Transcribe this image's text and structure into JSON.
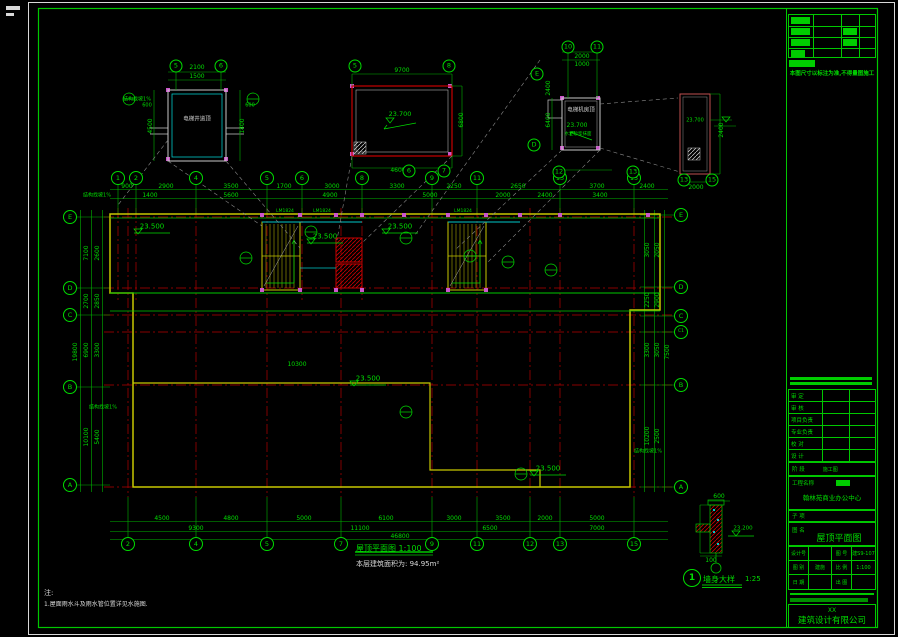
{
  "meta": {
    "bg": "#000000",
    "line_green": "#00dc00",
    "axis_red": "#b40000",
    "wall_yellow": "#c8c800",
    "cyan": "#00c8c8",
    "magenta": "#cc55cc",
    "white": "#d8d8d8",
    "leader_grey": "#8a8a8a"
  },
  "captions": {
    "plan_title": "屋顶平面图 1:100",
    "area_note": "本层建筑面积为: 94.95m²",
    "detail_circle": "1",
    "detail_title": "墙身大样",
    "detail_scale": "1:25",
    "note_head": "注:",
    "note_line": "1.屋面雨水斗及雨水管位置详见水施图."
  },
  "titleblock": {
    "note_top": "本图尺寸以标注为准,不得量图施工",
    "personnel_rows": [
      "审 定",
      "审 核",
      "项目负责",
      "专业负责",
      "校 对",
      "设 计"
    ],
    "stage_label": "阶 段",
    "stage_value": "施工图",
    "project_label": "工程名称",
    "project_value": "翰林苑商业办公中心",
    "sub_label": "子 项",
    "name_label": "图 名",
    "name_value": "屋顶平面图",
    "grid_cells": [
      [
        "设计号",
        ""
      ],
      [
        "图 号",
        "建S9-107"
      ],
      [
        "图 别",
        "建施"
      ],
      [
        "比 例",
        "1:100"
      ],
      [
        "日 期",
        ""
      ],
      [
        "出 图",
        ""
      ]
    ],
    "company_prefix": "XX",
    "company_name": "建筑设计有限公司"
  },
  "plan": {
    "bubbles": [
      {
        "t": "2",
        "x": 128,
        "y": 544
      },
      {
        "t": "4",
        "x": 196,
        "y": 544
      },
      {
        "t": "5",
        "x": 267,
        "y": 544
      },
      {
        "t": "7",
        "x": 341,
        "y": 544
      },
      {
        "t": "9",
        "x": 432,
        "y": 544
      },
      {
        "t": "11",
        "x": 477,
        "y": 544
      },
      {
        "t": "12",
        "x": 530,
        "y": 544
      },
      {
        "t": "13",
        "x": 560,
        "y": 544
      },
      {
        "t": "15",
        "x": 634,
        "y": 544
      },
      {
        "t": "1",
        "x": 118,
        "y": 178
      },
      {
        "t": "2",
        "x": 136,
        "y": 178
      },
      {
        "t": "4",
        "x": 196,
        "y": 178
      },
      {
        "t": "5",
        "x": 267,
        "y": 178
      },
      {
        "t": "6",
        "x": 302,
        "y": 178
      },
      {
        "t": "8",
        "x": 362,
        "y": 178
      },
      {
        "t": "9",
        "x": 432,
        "y": 178
      },
      {
        "t": "11",
        "x": 477,
        "y": 178
      },
      {
        "t": "13",
        "x": 560,
        "y": 178
      },
      {
        "t": "15",
        "x": 634,
        "y": 178
      },
      {
        "t": "E",
        "x": 70,
        "y": 217
      },
      {
        "t": "D",
        "x": 70,
        "y": 288
      },
      {
        "t": "C",
        "x": 70,
        "y": 315
      },
      {
        "t": "B",
        "x": 70,
        "y": 387
      },
      {
        "t": "A",
        "x": 70,
        "y": 485
      },
      {
        "t": "E",
        "x": 681,
        "y": 215
      },
      {
        "t": "D",
        "x": 681,
        "y": 287
      },
      {
        "t": "C",
        "x": 681,
        "y": 316
      },
      {
        "t": "C1",
        "x": 681,
        "y": 332,
        "s": 4.5
      },
      {
        "t": "B",
        "x": 681,
        "y": 385
      },
      {
        "t": "A",
        "x": 681,
        "y": 487
      },
      {
        "t": "5",
        "x": 176,
        "y": 66,
        "d": 11
      },
      {
        "t": "6",
        "x": 221,
        "y": 66,
        "d": 11
      },
      {
        "t": "5",
        "x": 355,
        "y": 66,
        "d": 11
      },
      {
        "t": "8",
        "x": 449,
        "y": 66,
        "d": 11
      },
      {
        "t": "6",
        "x": 409,
        "y": 171,
        "d": 11
      },
      {
        "t": "7",
        "x": 444,
        "y": 171,
        "d": 11
      },
      {
        "t": "10",
        "x": 568,
        "y": 47,
        "d": 11
      },
      {
        "t": "11",
        "x": 597,
        "y": 47,
        "d": 11
      },
      {
        "t": "E",
        "x": 537,
        "y": 74,
        "d": 11
      },
      {
        "t": "D",
        "x": 534,
        "y": 145,
        "d": 11
      },
      {
        "t": "12",
        "x": 559,
        "y": 172,
        "d": 11
      },
      {
        "t": "13",
        "x": 633,
        "y": 172,
        "d": 11
      },
      {
        "t": "13",
        "x": 684,
        "y": 180,
        "d": 11
      },
      {
        "t": "15",
        "x": 712,
        "y": 180,
        "d": 11
      }
    ],
    "labels": [
      {
        "t": "900",
        "x": 127,
        "y": 187
      },
      {
        "t": "2900",
        "x": 166,
        "y": 187
      },
      {
        "t": "3500",
        "x": 231,
        "y": 187
      },
      {
        "t": "1700",
        "x": 284,
        "y": 187
      },
      {
        "t": "3000",
        "x": 332,
        "y": 187
      },
      {
        "t": "3300",
        "x": 397,
        "y": 187
      },
      {
        "t": "2250",
        "x": 454,
        "y": 187
      },
      {
        "t": "2650",
        "x": 518,
        "y": 187
      },
      {
        "t": "3700",
        "x": 597,
        "y": 187
      },
      {
        "t": "2400",
        "x": 647,
        "y": 187
      },
      {
        "t": "1400",
        "x": 150,
        "y": 196
      },
      {
        "t": "5600",
        "x": 231,
        "y": 196
      },
      {
        "t": "4900",
        "x": 330,
        "y": 196
      },
      {
        "t": "5000",
        "x": 430,
        "y": 196
      },
      {
        "t": "2000",
        "x": 503,
        "y": 196
      },
      {
        "t": "2400",
        "x": 545,
        "y": 196
      },
      {
        "t": "3400",
        "x": 600,
        "y": 196
      },
      {
        "t": "4500",
        "x": 162,
        "y": 519
      },
      {
        "t": "4800",
        "x": 231,
        "y": 519
      },
      {
        "t": "5000",
        "x": 304,
        "y": 519
      },
      {
        "t": "6100",
        "x": 386,
        "y": 519
      },
      {
        "t": "3000",
        "x": 454,
        "y": 519
      },
      {
        "t": "3500",
        "x": 503,
        "y": 519
      },
      {
        "t": "2000",
        "x": 545,
        "y": 519
      },
      {
        "t": "5000",
        "x": 597,
        "y": 519
      },
      {
        "t": "9300",
        "x": 196,
        "y": 529
      },
      {
        "t": "11100",
        "x": 360,
        "y": 529
      },
      {
        "t": "6500",
        "x": 490,
        "y": 529
      },
      {
        "t": "7000",
        "x": 597,
        "y": 529
      },
      {
        "t": "46800",
        "x": 400,
        "y": 537
      },
      {
        "t": "7100",
        "x": 87,
        "y": 253,
        "r": 1
      },
      {
        "t": "2700",
        "x": 87,
        "y": 301,
        "r": 1
      },
      {
        "t": "6900",
        "x": 87,
        "y": 350,
        "r": 1
      },
      {
        "t": "10100",
        "x": 87,
        "y": 437,
        "r": 1
      },
      {
        "t": "2600",
        "x": 98,
        "y": 253,
        "r": 1
      },
      {
        "t": "2850",
        "x": 98,
        "y": 301,
        "r": 1
      },
      {
        "t": "3300",
        "x": 98,
        "y": 350,
        "r": 1
      },
      {
        "t": "5400",
        "x": 98,
        "y": 437,
        "r": 1
      },
      {
        "t": "19800",
        "x": 76,
        "y": 352,
        "r": 1
      },
      {
        "t": "3050",
        "x": 648,
        "y": 250,
        "r": 1
      },
      {
        "t": "2250",
        "x": 648,
        "y": 300,
        "r": 1
      },
      {
        "t": "3300",
        "x": 648,
        "y": 350,
        "r": 1
      },
      {
        "t": "10200",
        "x": 648,
        "y": 436,
        "r": 1
      },
      {
        "t": "2050",
        "x": 658,
        "y": 250,
        "r": 1
      },
      {
        "t": "2900",
        "x": 658,
        "y": 300,
        "r": 1
      },
      {
        "t": "3050",
        "x": 658,
        "y": 350,
        "r": 1
      },
      {
        "t": "2500",
        "x": 658,
        "y": 436,
        "r": 1
      },
      {
        "t": "7500",
        "x": 668,
        "y": 352,
        "r": 1
      },
      {
        "t": "2100",
        "x": 197,
        "y": 68
      },
      {
        "t": "1500",
        "x": 197,
        "y": 77
      },
      {
        "t": "4500",
        "x": 151,
        "y": 126,
        "r": 1
      },
      {
        "t": "1400",
        "x": 243,
        "y": 126,
        "r": 1
      },
      {
        "t": "600",
        "x": 147,
        "y": 106,
        "s": 5
      },
      {
        "t": "600",
        "x": 250,
        "y": 106,
        "s": 5
      },
      {
        "t": "9700",
        "x": 402,
        "y": 71
      },
      {
        "t": "6800",
        "x": 462,
        "y": 120,
        "r": 1
      },
      {
        "t": "4600",
        "x": 398,
        "y": 171
      },
      {
        "t": "2000",
        "x": 582,
        "y": 57
      },
      {
        "t": "1000",
        "x": 582,
        "y": 65
      },
      {
        "t": "2400",
        "x": 549,
        "y": 88,
        "r": 1
      },
      {
        "t": "6400",
        "x": 549,
        "y": 120,
        "r": 1
      },
      {
        "t": "2400",
        "x": 722,
        "y": 130,
        "r": 1
      },
      {
        "t": "2000",
        "x": 696,
        "y": 188
      },
      {
        "t": "600",
        "x": 719,
        "y": 497
      },
      {
        "t": "100",
        "x": 711,
        "y": 561
      },
      {
        "t": "10300",
        "x": 297,
        "y": 365
      },
      {
        "t": "23.500",
        "x": 152,
        "y": 227,
        "s": 7,
        "n": "elevation-label"
      },
      {
        "t": "23.500",
        "x": 325,
        "y": 237,
        "s": 7,
        "n": "elevation-label"
      },
      {
        "t": "23.500",
        "x": 400,
        "y": 227,
        "s": 7,
        "n": "elevation-label"
      },
      {
        "t": "23.500",
        "x": 368,
        "y": 379,
        "s": 7,
        "n": "elevation-label"
      },
      {
        "t": "23.500",
        "x": 548,
        "y": 469,
        "s": 7,
        "n": "elevation-label"
      },
      {
        "t": "23.700",
        "x": 400,
        "y": 114,
        "s": 6.5,
        "n": "elevation-label"
      },
      {
        "t": "23.700",
        "x": 577,
        "y": 126,
        "s": 6,
        "n": "elevation-label"
      },
      {
        "t": "23.700",
        "x": 695,
        "y": 121,
        "s": 5,
        "n": "elevation-label"
      },
      {
        "t": "23.200",
        "x": 743,
        "y": 529,
        "s": 5.5,
        "n": "elevation-label"
      },
      {
        "t": "LM1824",
        "x": 285,
        "y": 212,
        "s": 4.5,
        "n": "door-tag"
      },
      {
        "t": "LM1824",
        "x": 322,
        "y": 212,
        "s": 4.5,
        "n": "door-tag"
      },
      {
        "t": "LM1824",
        "x": 463,
        "y": 212,
        "s": 4.5,
        "n": "door-tag"
      },
      {
        "t": "结构找坡1%",
        "x": 97,
        "y": 196,
        "s": 5,
        "n": "slope-note"
      },
      {
        "t": "结构找坡1%",
        "x": 103,
        "y": 408,
        "s": 5,
        "n": "slope-note"
      },
      {
        "t": "结构找坡1%",
        "x": 137,
        "y": 100,
        "s": 5,
        "n": "slope-note"
      },
      {
        "t": "结构找坡1%",
        "x": 648,
        "y": 452,
        "s": 5,
        "n": "slope-note"
      },
      {
        "t": "电梯机房顶",
        "x": 581,
        "y": 111,
        "s": 5.5,
        "c": "w",
        "n": "room-label"
      },
      {
        "t": "电梯井道顶",
        "x": 197,
        "y": 120,
        "s": 5.5,
        "c": "w",
        "n": "room-label"
      },
      {
        "t": "水泥砂浆抹面",
        "x": 578,
        "y": 135,
        "s": 4.5,
        "n": "finish-note"
      }
    ]
  }
}
